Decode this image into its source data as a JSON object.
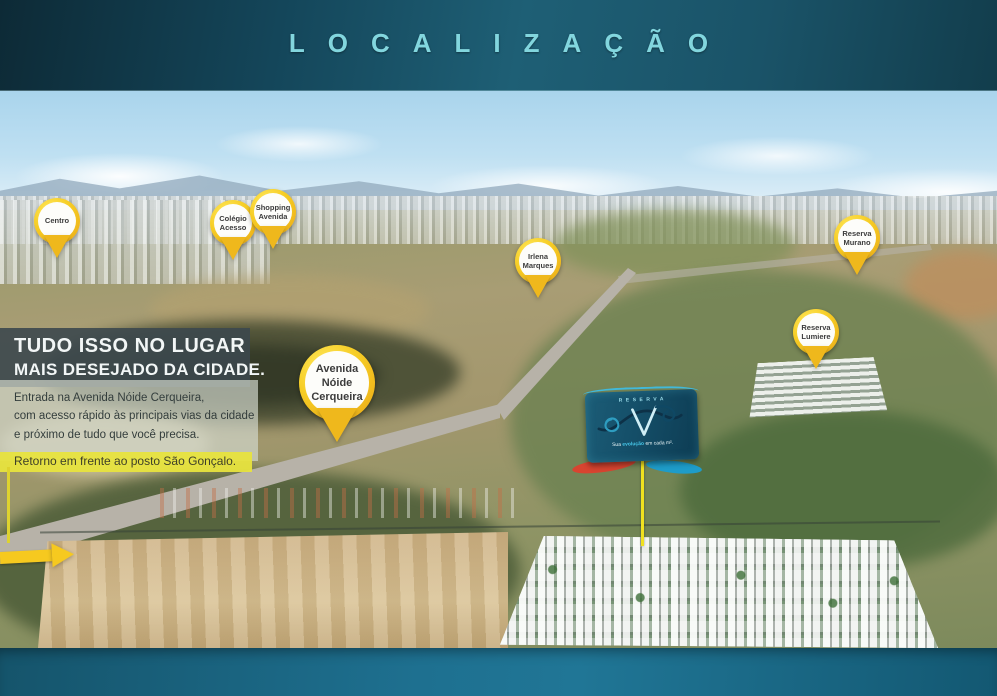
{
  "header": {
    "title": "LOCALIZAÇÃO"
  },
  "info_panel": {
    "heading_line1": "TUDO ISSO NO LUGAR",
    "heading_line2": "MAIS DESEJADO DA CIDADE.",
    "body_line1": "Entrada na Avenida Nóide Cerqueira,",
    "body_line2": "com acesso rápido às principais vias da cidade",
    "body_line3": "e próximo de tudo que você precisa.",
    "highlight": "Retorno em frente ao posto São Gonçalo."
  },
  "pins": {
    "centro": {
      "line1": "Centro"
    },
    "colegio_acesso": {
      "line1": "Colégio",
      "line2": "Acesso"
    },
    "shopping_avenida": {
      "line1": "Shopping",
      "line2": "Avenida"
    },
    "irlena_marques": {
      "line1": "Irlena",
      "line2": "Marques"
    },
    "reserva_murano": {
      "line1": "Reserva",
      "line2": "Murano"
    },
    "reserva_lumiere": {
      "line1": "Reserva",
      "line2": "Lumiere"
    },
    "avenida_noide": {
      "line1": "Avenida",
      "line2": "Nóide",
      "line3": "Cerqueira"
    }
  },
  "billboard": {
    "brand": "RESERVA",
    "tagline_pre": "Sua ",
    "tagline_highlight": "evolução",
    "tagline_post": " em cada m²."
  },
  "colors": {
    "pin_yellow": "#f6cd25",
    "highlight_yellow": "#e7e33e",
    "teal_dark": "#14465a",
    "teal_title": "#82d6de",
    "billboard_teal": "#15506a",
    "logo_cyan": "#41b9da"
  }
}
